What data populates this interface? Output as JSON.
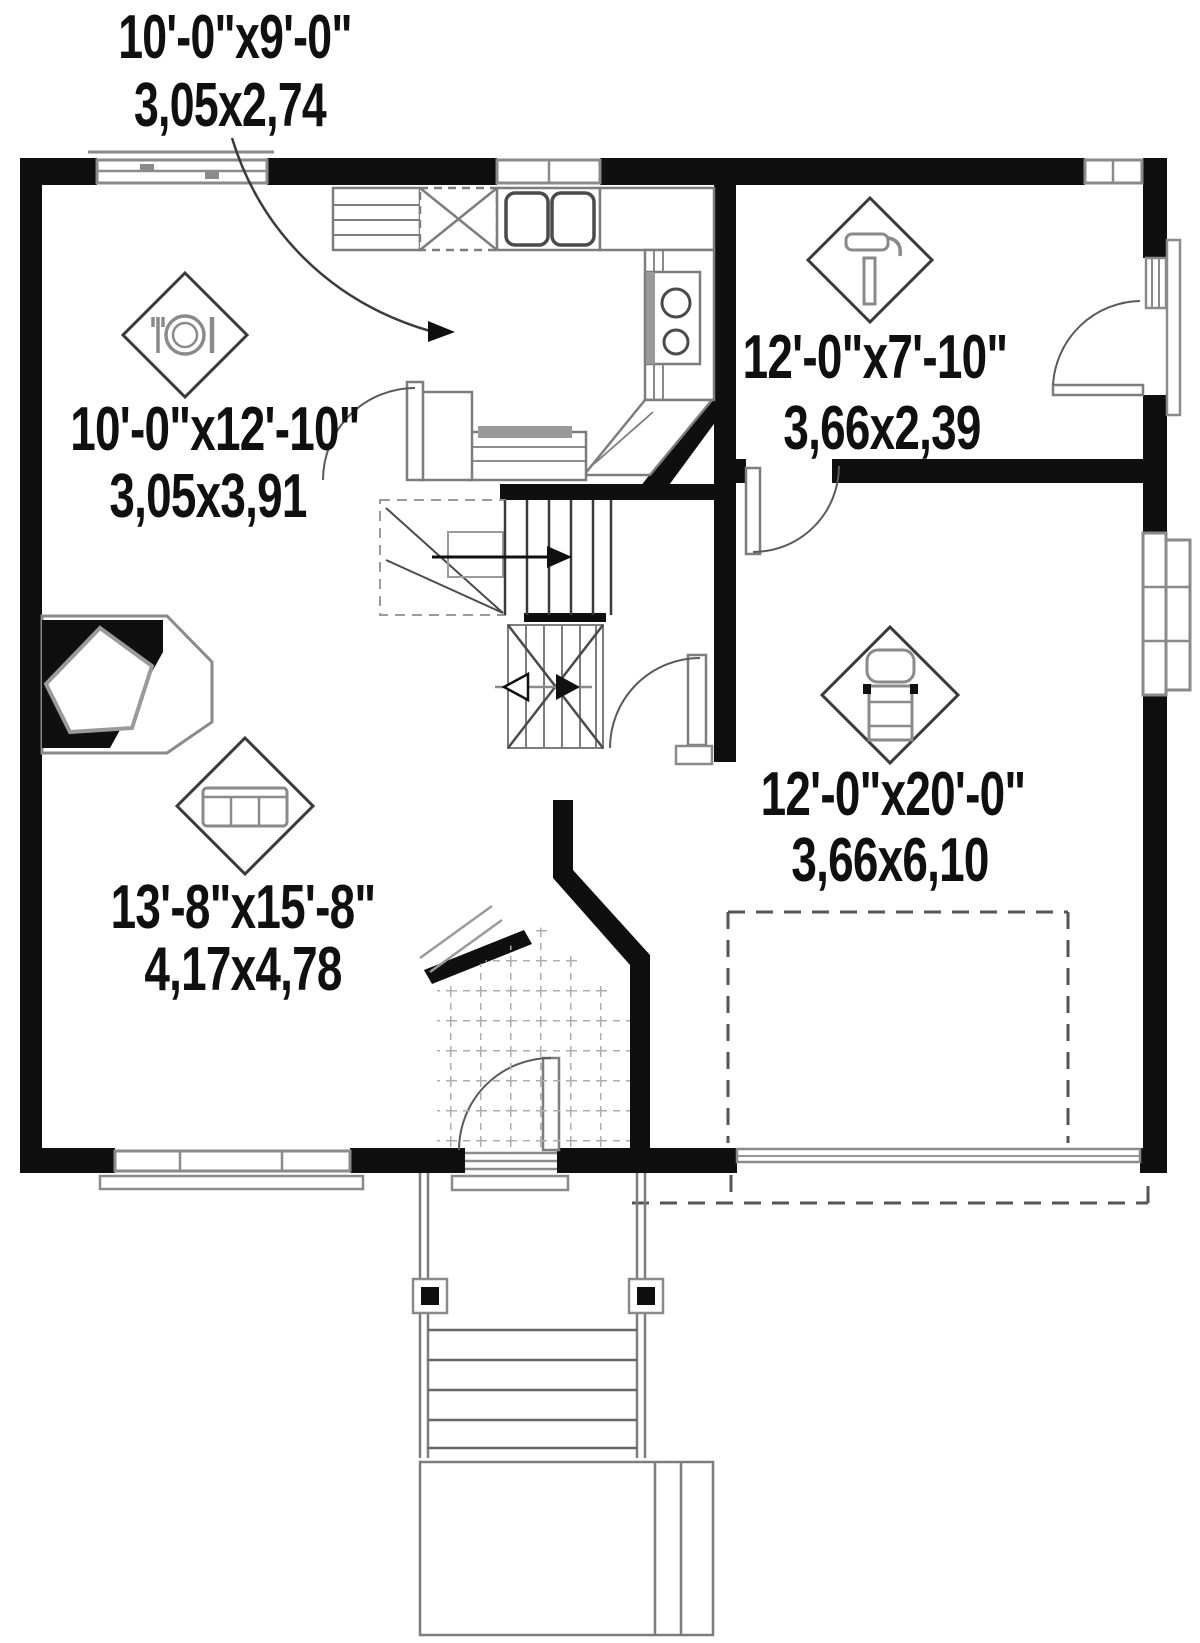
{
  "plan": {
    "title": "first-floor-plan",
    "rooms": [
      {
        "name": "kitchen",
        "imperial": "10'-0\"x9'-0\"",
        "metric": "3,05x2,74"
      },
      {
        "name": "dining",
        "imperial": "10'-0\"x12'-10\"",
        "metric": "3,05x3,91"
      },
      {
        "name": "workshop",
        "imperial": "12'-0\"x7'-10\"",
        "metric": "3,66x2,39"
      },
      {
        "name": "garage",
        "imperial": "12'-0\"x20'-0\"",
        "metric": "3,66x6,10"
      },
      {
        "name": "living",
        "imperial": "13'-8\"x15'-8\"",
        "metric": "4,17x4,78"
      }
    ],
    "icons": {
      "dining": "plate-and-cutlery-icon",
      "workshop": "hammer-icon",
      "garage": "car-icon",
      "living": "sofa-icon"
    },
    "colors": {
      "wall": "#0f0f0f",
      "fixture": "#8a8a8a",
      "thin_line": "#6e6e6e",
      "background": "#ffffff"
    }
  }
}
